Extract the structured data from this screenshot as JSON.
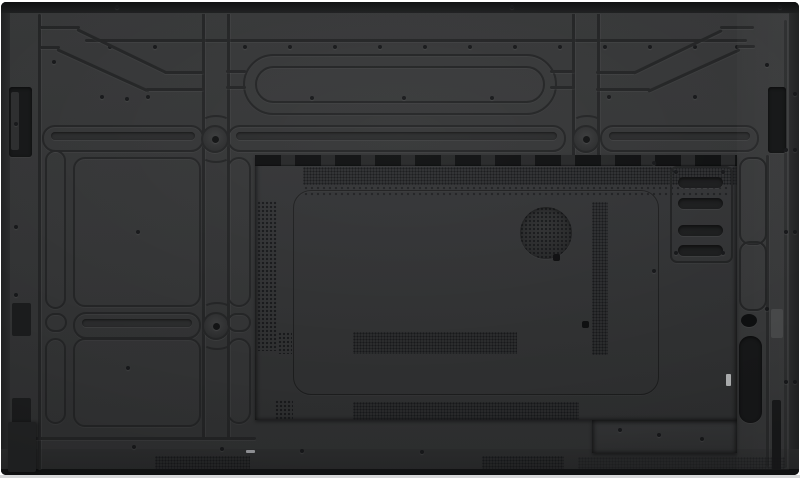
{
  "figure": {
    "alt": "Rear view of a large black flat-panel display: embossed rib channels and VESA mount rails, a recessed component bay with ventilation dot grilles, a round speaker grille, a four-slot port cover plate, side handle recesses and bottom vent strips"
  },
  "colors": {
    "page": "#ffffff",
    "back_top": "#363738",
    "back": "#323334",
    "back_bottom": "#2e2f30",
    "edge": "#1e1f20",
    "edge_dark": "#121314",
    "groove": "#232425",
    "vent_dot": "#17181a",
    "recess": "#161718",
    "hole": "#0e0f10",
    "tab_gray": "#474849",
    "connector_white": "#aeb0b1",
    "floor": "#d6d7d8"
  }
}
